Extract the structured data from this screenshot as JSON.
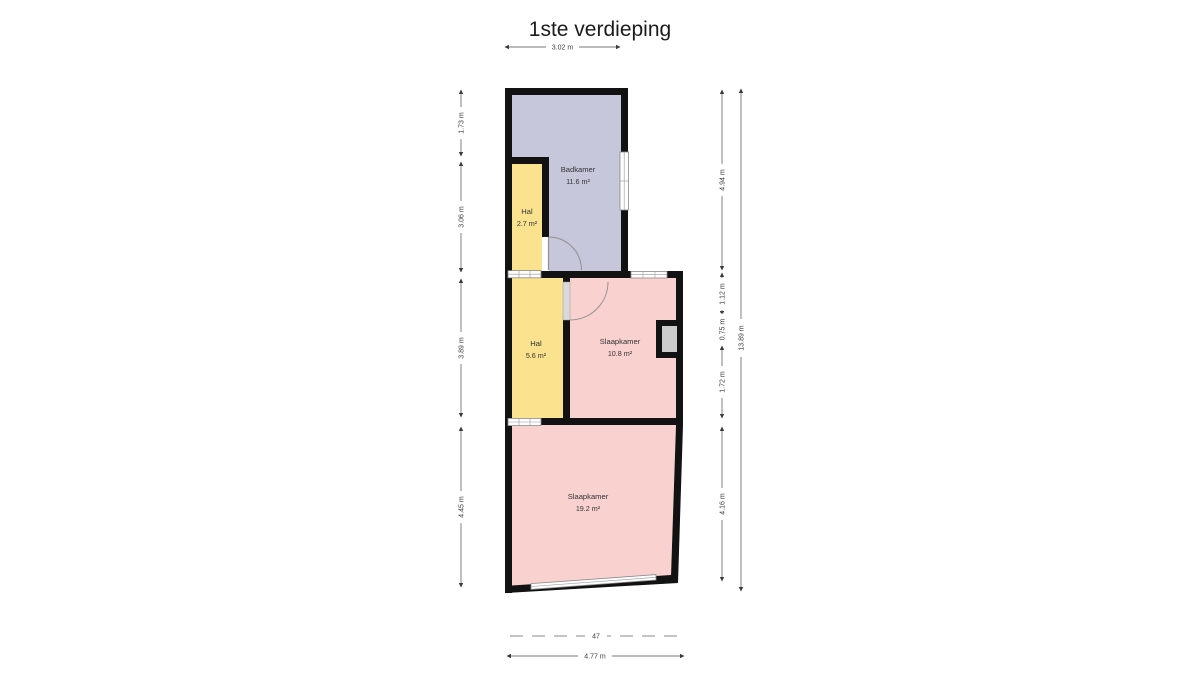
{
  "title": "1ste verdieping",
  "floor_plan": {
    "wall_color": "#121212",
    "rooms": [
      {
        "name": "Badkamer",
        "area": "11.6 m²",
        "color": "#c6c7da"
      },
      {
        "name": "Hal",
        "area": "2.7 m²",
        "color": "#fae28f"
      },
      {
        "name": "Hal",
        "area": "5.6 m²",
        "color": "#fae28f"
      },
      {
        "name": "Slaapkamer",
        "area": "10.8 m²",
        "color": "#f9d2d0"
      },
      {
        "name": "Slaapkamer",
        "area": "19.2 m²",
        "color": "#f9d2d0"
      }
    ]
  },
  "dimensions": {
    "top_width": "3.02 m",
    "left": [
      "1.73 m",
      "3.06 m",
      "3.89 m",
      "4.45 m"
    ],
    "right": [
      "4.94 m",
      "1.12 m",
      "0.75 m",
      "1.72 m",
      "4.16 m"
    ],
    "right_total": "13.89 m",
    "bottom_width": "4.77 m",
    "parcel_number": "47"
  }
}
